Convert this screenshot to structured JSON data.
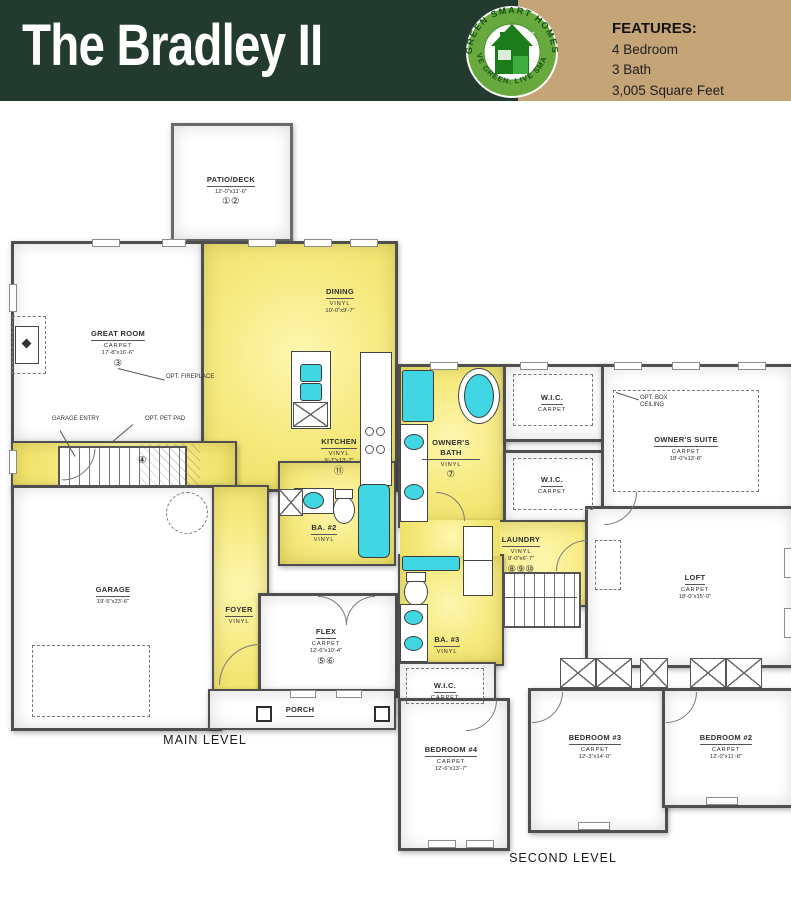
{
  "header": {
    "title": "The Bradley II",
    "logo": {
      "arc_top": "GREEN SMART HOMES",
      "arc_bottom": "LIVE GREEN. LIVE SMART"
    },
    "features": {
      "heading": "FEATURES:",
      "items": [
        "4 Bedroom",
        "3 Bath",
        "3,005 Square Feet"
      ]
    }
  },
  "colors": {
    "header_green": "#223b2e",
    "tan_panel": "#c5a477",
    "plan_yellow": "#f6e97e",
    "fixture_cyan": "#41d6e3",
    "wall_gray": "#4f4f4f",
    "logo_green": "#67a93c"
  },
  "main_level": {
    "caption": "MAIN LEVEL",
    "rooms": {
      "patio": {
        "name": "PATIO/DECK",
        "dims": "12'-0\"x11'-6\"",
        "badges": "①②"
      },
      "great_room": {
        "name": "GREAT ROOM",
        "flooring": "CARPET",
        "dims": "17'-8\"x16'-6\"",
        "badges": "③"
      },
      "dining": {
        "name": "DINING",
        "flooring": "VINYL",
        "dims": "10'-0\"x9'-7\""
      },
      "kitchen": {
        "name": "KITCHEN",
        "flooring": "VINYL",
        "dims": "9'-7\"x13'-7\"",
        "badges": "⑪"
      },
      "bath2": {
        "name": "BA. #2",
        "flooring": "VINYL"
      },
      "garage": {
        "name": "GARAGE",
        "dims": "19'-5\"x23'-6\""
      },
      "foyer": {
        "name": "FOYER",
        "flooring": "VINYL"
      },
      "flex": {
        "name": "FLEX",
        "flooring": "CARPET",
        "dims": "12'-6\"x10'-4\"",
        "badges": "⑤⑥"
      },
      "porch": {
        "name": "PORCH"
      },
      "stairs_badge": "④"
    },
    "annotations": {
      "fireplace": "OPT. FIREPLACE",
      "garage_entry": "GARAGE ENTRY",
      "pet_pad": "OPT. PET PAD"
    }
  },
  "second_level": {
    "caption": "SECOND LEVEL",
    "rooms": {
      "owners_bath": {
        "name": "OWNER'S BATH",
        "flooring": "VINYL",
        "badges": "⑦"
      },
      "wic1": {
        "name": "W.I.C.",
        "flooring": "CARPET"
      },
      "wic2": {
        "name": "W.I.C.",
        "flooring": "CARPET"
      },
      "owners_suite": {
        "name": "OWNER'S SUITE",
        "flooring": "CARPET",
        "dims": "18'-0\"x13'-8\""
      },
      "laundry": {
        "name": "LAUNDRY",
        "flooring": "VINYL",
        "dims": "9'-0\"x6'-7\"",
        "badges": "⑧⑨⑩"
      },
      "loft": {
        "name": "LOFT",
        "flooring": "CARPET",
        "dims": "18'-0\"x15'-0\""
      },
      "bath3": {
        "name": "BA. #3",
        "flooring": "VINYL"
      },
      "wic3": {
        "name": "W.I.C.",
        "flooring": "CARPET"
      },
      "bedroom4": {
        "name": "BEDROOM #4",
        "flooring": "CARPET",
        "dims": "12'-6\"x13'-7\""
      },
      "bedroom3": {
        "name": "BEDROOM #3",
        "flooring": "CARPET",
        "dims": "12'-3\"x14'-0\""
      },
      "bedroom2": {
        "name": "BEDROOM #2",
        "flooring": "CARPET",
        "dims": "12'-0\"x11'-8\""
      }
    },
    "annotations": {
      "box_ceiling": "OPT. BOX CEILING"
    }
  }
}
